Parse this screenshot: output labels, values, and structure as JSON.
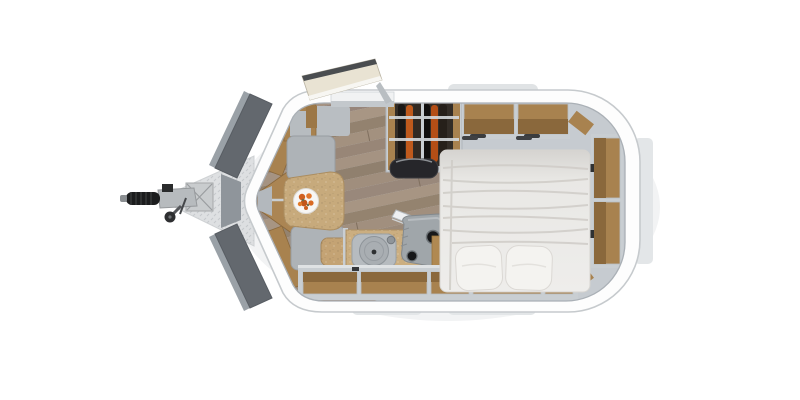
{
  "scene": {
    "title": "Top-view floor plan render of a compact teardrop caravan travel trailer",
    "view": "overhead orthographic 3D render, no visible text",
    "background_color": "#ffffff",
    "trailer": {
      "body": "white rounded shell with pointed front prow on the left and rounded rear on the right",
      "front_windows": "two dark grey angled panels on the prow nose with silver outer trim",
      "entry_door": "open door panel swung outward over the top wall, cream face with dark edge",
      "roof_bump_label": "exterior roof hatch bump (top)",
      "side_bump_label": "exterior bump on right rear wall",
      "bottom_tab_count": 2
    },
    "hitch": {
      "parts": [
        "diamond-plate a-frame drawbar",
        "coupler body",
        "black ribbed coupler handle",
        "jockey wheel",
        "mounting bracket"
      ],
      "position": "extends left from the prow point"
    },
    "interior": {
      "floor": "diagonal grey-brown wood planks",
      "dinette": {
        "benches": 2,
        "table": "tan speckled table with cut corners",
        "table_decor": "white plate with orange flowers",
        "stool": "small tan speckled stool"
      },
      "kitchenette": {
        "countertop": "tan speckled counter along bottom wall",
        "sink": "round grey basin with drain and faucet",
        "appliance": "grey unit with two dark burner/bowl openings",
        "lid": "white board propped diagonally above the counter"
      },
      "wardrobe": {
        "state": "open, seen from above",
        "garment_count": 6,
        "garment_colors": [
          "#1b1816",
          "#c05a1c",
          "#332a22",
          "#100e0d",
          "#b44e16",
          "#26201a"
        ],
        "rails": 2,
        "bag": "dark duffel bag at wardrobe base"
      },
      "bed": {
        "type": "double bed across the rear",
        "duvet": "white rumpled duvet with horizontal folds",
        "pillow_count": 2
      },
      "storage": {
        "prow_cabinet": "wood V-shaped cabinetry in the nose",
        "corner_cabinet": "wood corner cabinet with grey top at entry",
        "overhead_top_units": 2,
        "right_wall_shelves": 2,
        "bottom_wall_units": 5,
        "latch_marks": "small dark latches on shelf edges"
      }
    },
    "colors": {
      "shell": "#fdfdfd",
      "shell_outline": "#c6cacd",
      "wall_grey": "#c6cbd0",
      "inner_line": "#aab0b6",
      "cabinet_wood": "#a8824f",
      "cabinet_wood_shade": "#8a683c",
      "floor_plank_light": "#a59382",
      "floor_plank_dark": "#93826f",
      "upholstery_grey": "#aeb3b7",
      "countertop_tan": "#c9ac7e",
      "bed_linen": "#ecebe9",
      "pillow_white": "#f4f3f0",
      "window_dark_grey": "#63686e",
      "trim_silver": "#9aa1a7",
      "hitch_metal": "#b7bbbe",
      "hitch_black": "#1c1d1e",
      "flower_orange": "#d96a24",
      "wardrobe_interior": "#332d27",
      "bump_grey": "#e2e5e7"
    }
  }
}
